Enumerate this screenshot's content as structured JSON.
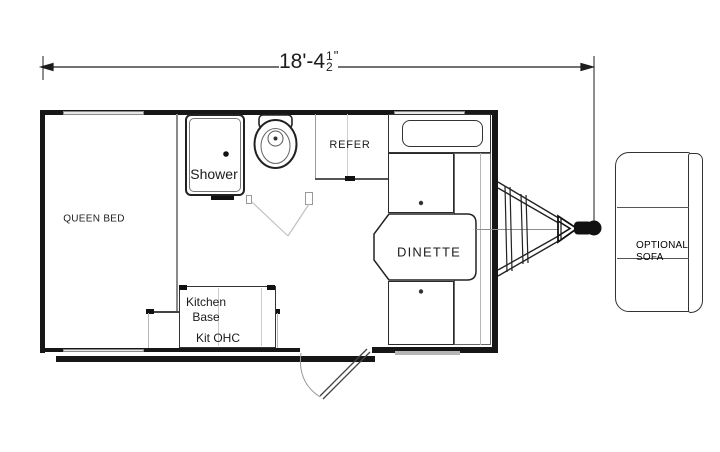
{
  "floorplan": {
    "dimension": {
      "whole": "18'-4",
      "frac_numerator": "1",
      "frac_denominator": "2",
      "unit_mark": "\""
    },
    "labels": {
      "queen_bed": "QUEEN BED",
      "shower": "Shower",
      "refer": "REFER",
      "dinette": "DINETTE",
      "kitchen_line1": "Kitchen",
      "kitchen_line2": "Base",
      "kitchen_ohc": "Kit OHC",
      "sofa_line1": "OPTIONAL",
      "sofa_line2": "SOFA"
    },
    "colors": {
      "wall": "#161616",
      "window_fill": "#e6e6e6",
      "furniture_line": "#333333",
      "light_line": "#b5b5b5"
    }
  }
}
